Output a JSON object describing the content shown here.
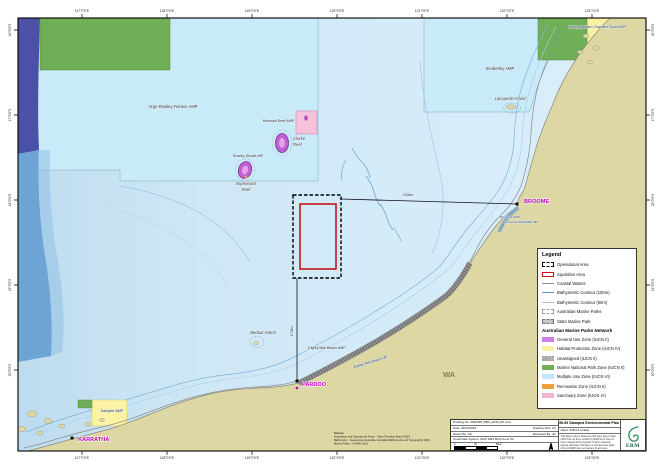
{
  "graticule": {
    "lon": [
      "117°0'0\"E",
      "118°0'0\"E",
      "119°0'0\"E",
      "120°0'0\"E",
      "121°0'0\"E",
      "122°0'0\"E",
      "123°0'0\"E"
    ],
    "lat": [
      "16°0'0\"S",
      "17°0'0\"S",
      "18°0'0\"S",
      "19°0'0\"S",
      "20°0'0\"S"
    ]
  },
  "map_labels": {
    "argo": "Argo-Rowley Terrace AMP",
    "mermaid": "Mermaid Reef AMP",
    "clerke1": "Clerke",
    "clerke2": "Reef",
    "rowley": "Rowley Shoals MP",
    "imperieuse1": "Imperieuse",
    "imperieuse2": "Reef",
    "kimberley": "Kimberley AMP",
    "lacepede": "Lacepede Island",
    "lalang": "Lalang-garram / Camden Sound MP",
    "broome": "BROOME",
    "roebuck": "Roebuck AMP",
    "unnamed": "Unnamed WA31586 MP",
    "dist_broome": "230km",
    "dist_pardoo": "170km",
    "bedout": "Bedout Island",
    "emb_amp": "Eighty Mile Beach AMP",
    "emb_mp": "Eighty Mile Beach MP",
    "pardoo": "PARDOO",
    "karratha": "KARRATHA",
    "dampier": "Dampier AMP",
    "wa": "WA"
  },
  "source": {
    "heading": "Source:",
    "line1": "Acquisition and Operational Areas - Client Provided March 2019",
    "line2": "Bathymetry - Geoscience Australia, Australian Bathymetry and Topography 2009",
    "line3": "Marine Parks - CAPAD 2016"
  },
  "legend": {
    "title": "Legend",
    "items": [
      "Operational Area",
      "Aquisition Area",
      "Coastal Waters",
      "Bathymetric Contour (100m)",
      "Bathymetric Contour (50m)",
      "Australian Marine Parks",
      "State Marine Park"
    ],
    "network_header": "Australian Marine Parks Network",
    "network_items": [
      "General Use Zone (IUCN II)",
      "Habitat Protection Zone (IUCN IV)",
      "Unassigned (IUCN II)",
      "Marine National Park Zone (IUCN II)",
      "Multiple Use Zone (IUCN VI)",
      "Recreation Zone (IUCN II)",
      "Sanctuary Zone (IUCN IA)"
    ]
  },
  "title_block": {
    "drawing_no": "Drawing No: 0546498_BI59_A030_R0.mxd",
    "date": "Date: 02/07/2019",
    "size": "Drawing Size: A4",
    "drawn": "Drawn By: GK",
    "reviewed": "Reviewed By: JD",
    "coord": "Coordinate System: GDA 1994 MGA Zone 50",
    "title": "BI-59 Stamped Environmental Plan",
    "client": "Client: SLB CA Limited",
    "disclaimer": "This figure may be based on third party data or data which has not been verified by ERM and it has not been independently checked. Unless expressly agreed otherwise, this figure is intended as a guide only and ERM does not warrant its accuracy.",
    "erm": "ERM",
    "scale": {
      "t0": "0",
      "t1": "25",
      "t2": "50km"
    }
  },
  "colors": {
    "ocean": "#d2eaf7",
    "land": "#ddd7a4",
    "amp_multiple_use": "#c9eaf9",
    "marine_national_park": "#70af58",
    "habitat_protection": "#fbf3a3",
    "deep_water": "#4a51a7",
    "mid_water": "#5f9ad0",
    "sanctuary_pink": "#f5c2d9",
    "reef_purple": "#c05fd0",
    "acquisition_red": "#c41414",
    "town_magenta": "#b800b8",
    "erm_green": "#14603e"
  }
}
